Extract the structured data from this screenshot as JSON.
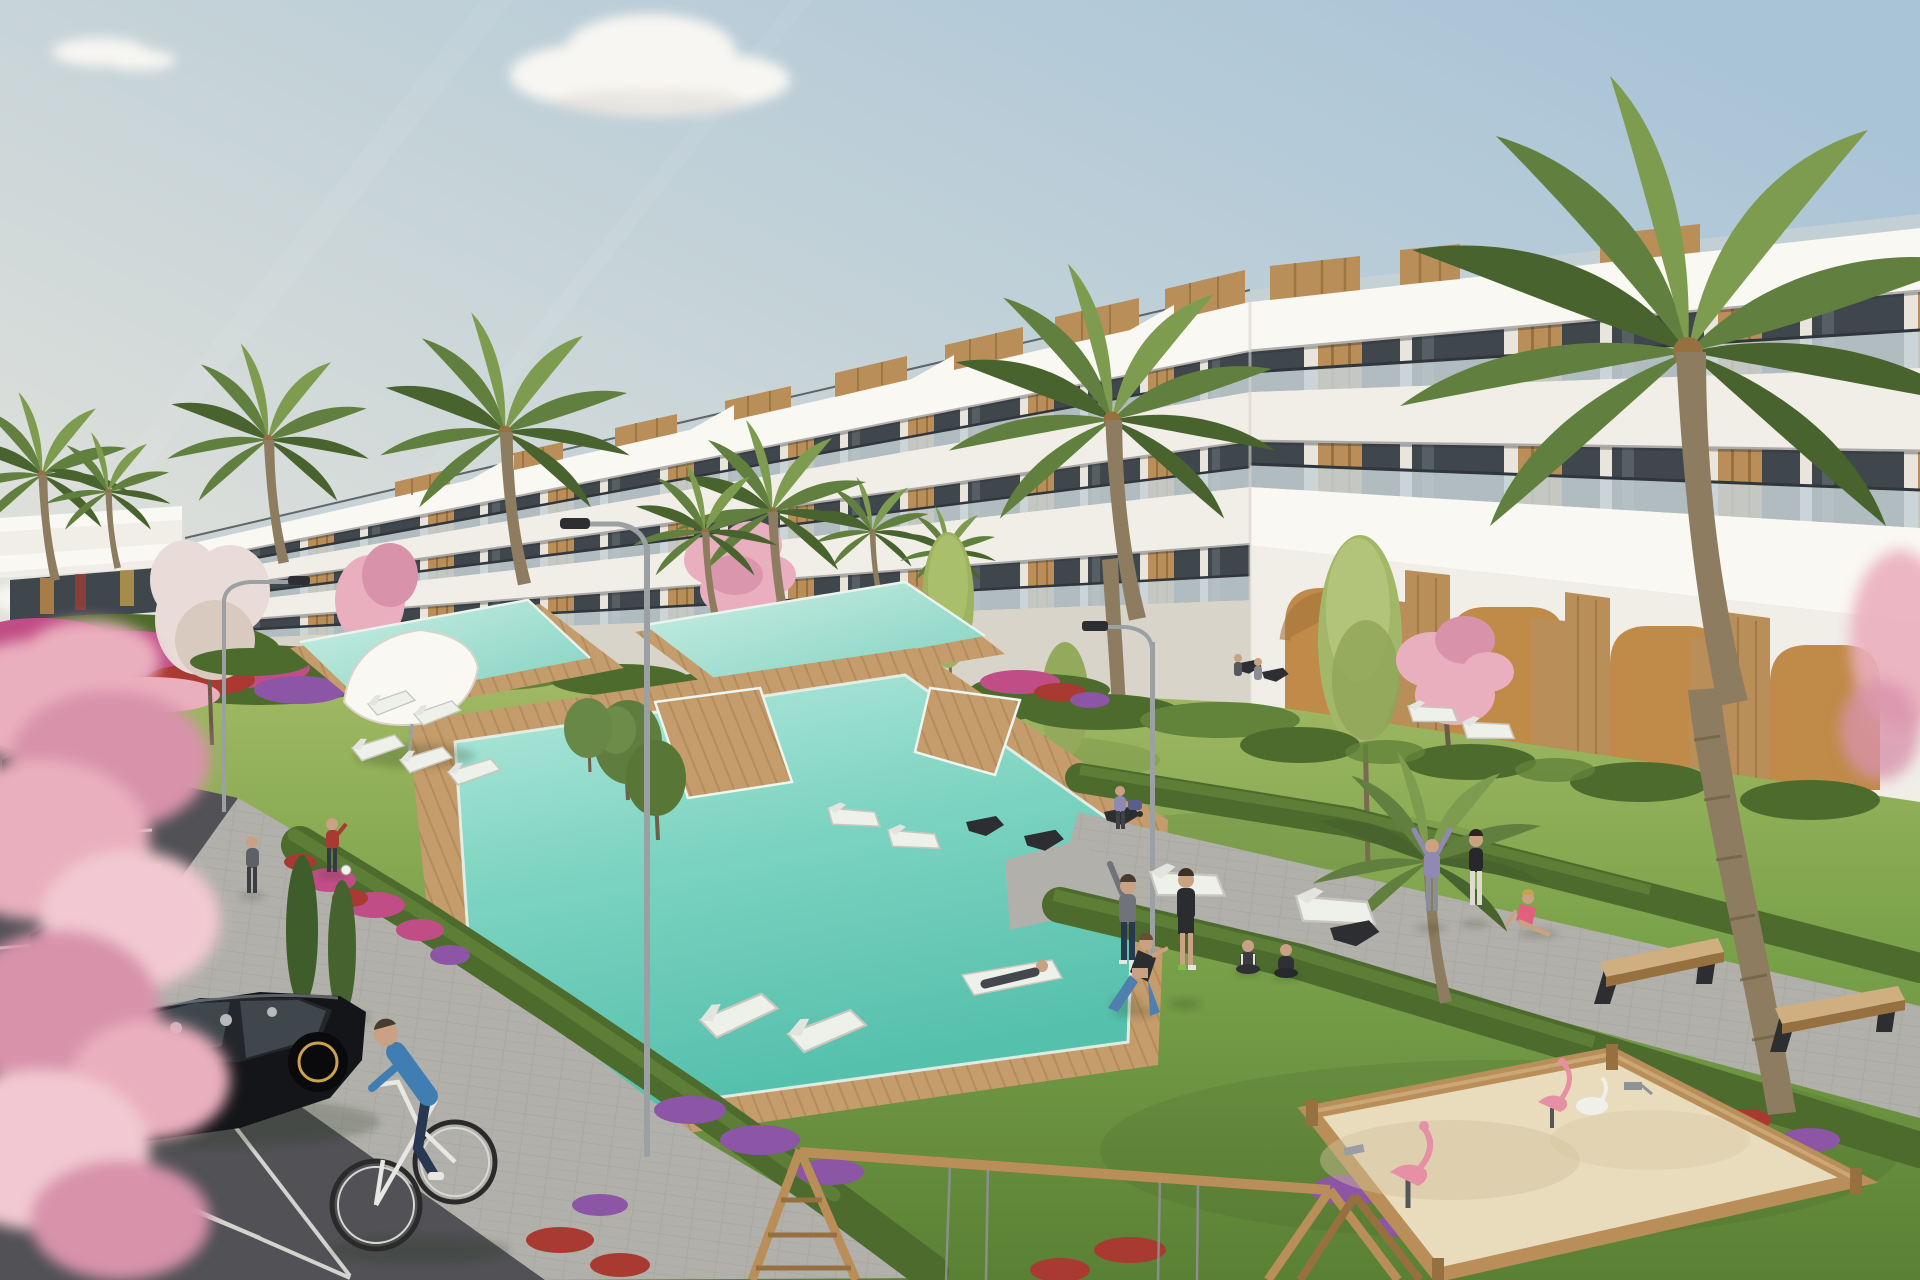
{
  "meta": {
    "type": "architectural-exterior-render",
    "description": "3D architectural rendering of a modern white terraced apartment complex with wood-clad accents, landscaped gardens with palm and blossom trees, three turquoise swimming pools with wooden decks, sun loungers, a parking area with dark cars, a man cycling, people exercising on the lawn, a wooden swing frame and a sandbox playground under a pale blue sky with scattered clouds."
  },
  "palette": {
    "skyTop": "#a9c4d7",
    "skyMid": "#c3d2d8",
    "skyLow": "#dcdfda",
    "skyWarm": "#eae4d5",
    "cloud": "#f8f6f2",
    "cloudShade": "#d9d4cd",
    "white": "#f1eee8",
    "whiteBright": "#faf8f2",
    "whiteShade": "#d9d4ca",
    "glass": "#3f474d",
    "glassHi": "#5b656c",
    "bal": "#c5d1d5",
    "rail": "#30363b",
    "wood": "#b98e58",
    "woodDark": "#96713f",
    "woodLight": "#cfae80",
    "tan": "#c08a48",
    "tanDark": "#a3753a",
    "palm": "#61803f",
    "palmDark": "#49632e",
    "palmLight": "#7e9c4f",
    "hedge": "#4c6b2d",
    "hedgeLight": "#61833a",
    "deck": "#c59c6c",
    "deckDark": "#a07848",
    "path": "#b2b0aa",
    "pathShade": "#9a9893",
    "asphalt": "#515156",
    "line": "#eceae5",
    "metal": "#9ba0a3",
    "dark": "#2c2e31",
    "carBlack": "#141518",
    "carNavy": "#25303d",
    "carGray": "#26282c",
    "sand": "#e8dcbd",
    "sandShade": "#d3c29c",
    "skin": "#c9a183",
    "magenta": "#c14d86",
    "purple": "#8d55a6",
    "red": "#a93a31",
    "pink": "#eaafbe",
    "pinkDeep": "#d893ab",
    "blossom": "#e9dcd8",
    "blue": "#3f7db3",
    "navy": "#273850",
    "teal": "#45a09a",
    "pinkShirt": "#e0708a",
    "gray": "#6b6e73",
    "black": "#2a2c2f",
    "purpleShirt": "#9089b3",
    "lime": "#a3b768",
    "trunk": "#8d7c5f"
  },
  "scene": {
    "sky": {
      "cloud_groups": 6
    },
    "buildings": {
      "main": "white stepped terraced apartment block with wood roof boxes and glass balustrades",
      "ground_floor": "arched porticos with tan walls and wood columns",
      "distant": "low white building with glazed front"
    },
    "water": {
      "pools": 3
    },
    "vegetation": {
      "palm_trees": 10,
      "blossom_trees": 8,
      "columnar_trees": 3,
      "hedges": 6,
      "flower_beds": 9
    },
    "recreation": {
      "sun_loungers": 14,
      "black_seats": 6,
      "wood_benches": 2,
      "canopy": 1,
      "parasol": 1,
      "sandbox": 1,
      "sandbox_toys": 5,
      "swing_frame": 1
    },
    "vehicles": {
      "parked_cars": 3,
      "bicycles": 1
    },
    "people": {
      "count": 17,
      "activities": [
        "walking",
        "cycling",
        "stretching",
        "yoga",
        "lunging",
        "sitting",
        "reclining",
        "playing-ball",
        "pushing-stroller"
      ]
    },
    "street_lamps": 3
  }
}
